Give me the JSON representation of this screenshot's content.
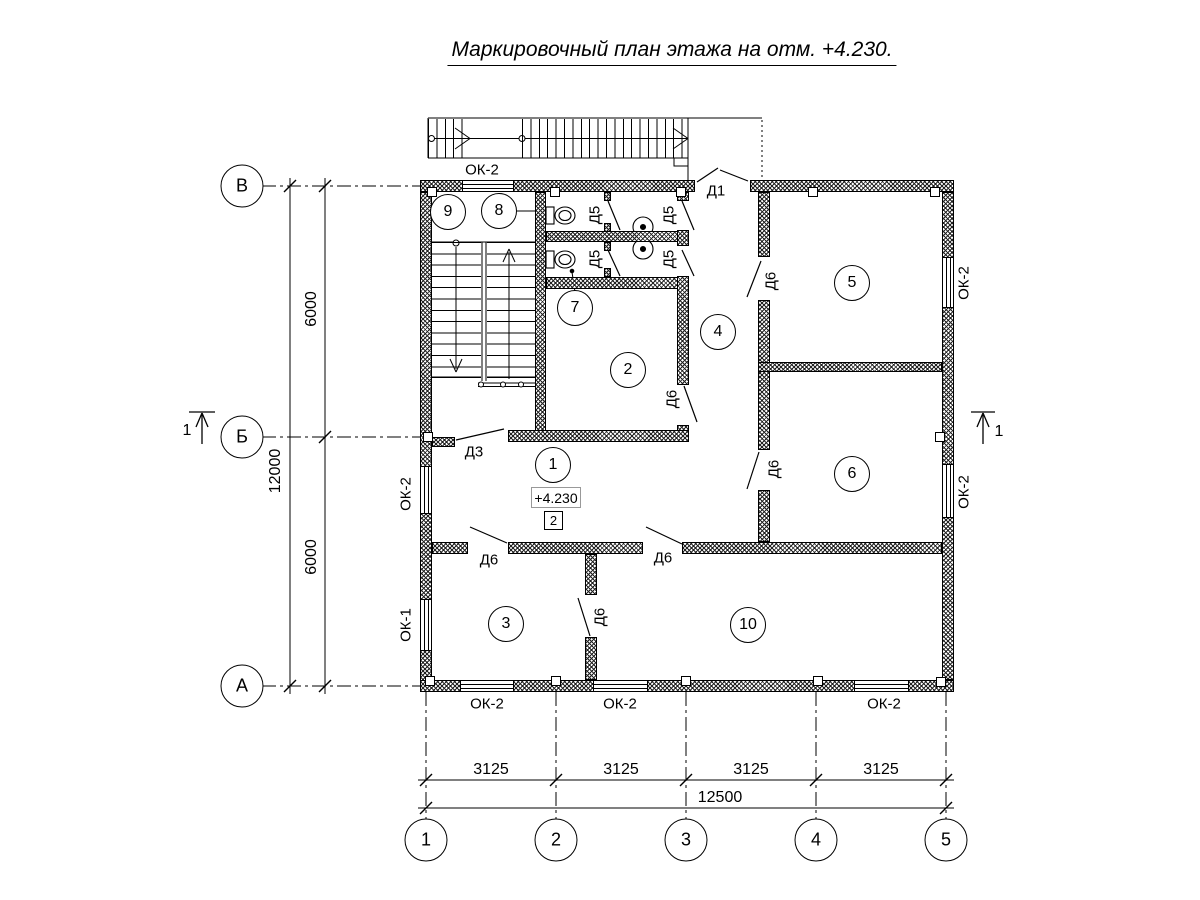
{
  "title": "Маркировочный план этажа на отм. +4.230.",
  "elevation": {
    "value": "+4.230",
    "zone_number": "2"
  },
  "rooms": {
    "r1": "1",
    "r2": "2",
    "r3": "3",
    "r4": "4",
    "r5": "5",
    "r6": "6",
    "r7": "7",
    "r8": "8",
    "r9": "9",
    "r10": "10"
  },
  "grid": {
    "row_axes": [
      "В",
      "Б",
      "А"
    ],
    "col_axes": [
      "1",
      "2",
      "3",
      "4",
      "5"
    ]
  },
  "dimensions": {
    "left_upper": "6000",
    "left_lower": "6000",
    "left_total": "12000",
    "bottom_segments": [
      "3125",
      "3125",
      "3125",
      "3125"
    ],
    "bottom_total": "12500"
  },
  "doors": {
    "d1": "Д1",
    "d3": "Д3",
    "d5": "Д5",
    "d6": "Д6"
  },
  "windows": {
    "ok1": "ОК-1",
    "ok2": "ОК-2"
  },
  "section_mark": "1"
}
